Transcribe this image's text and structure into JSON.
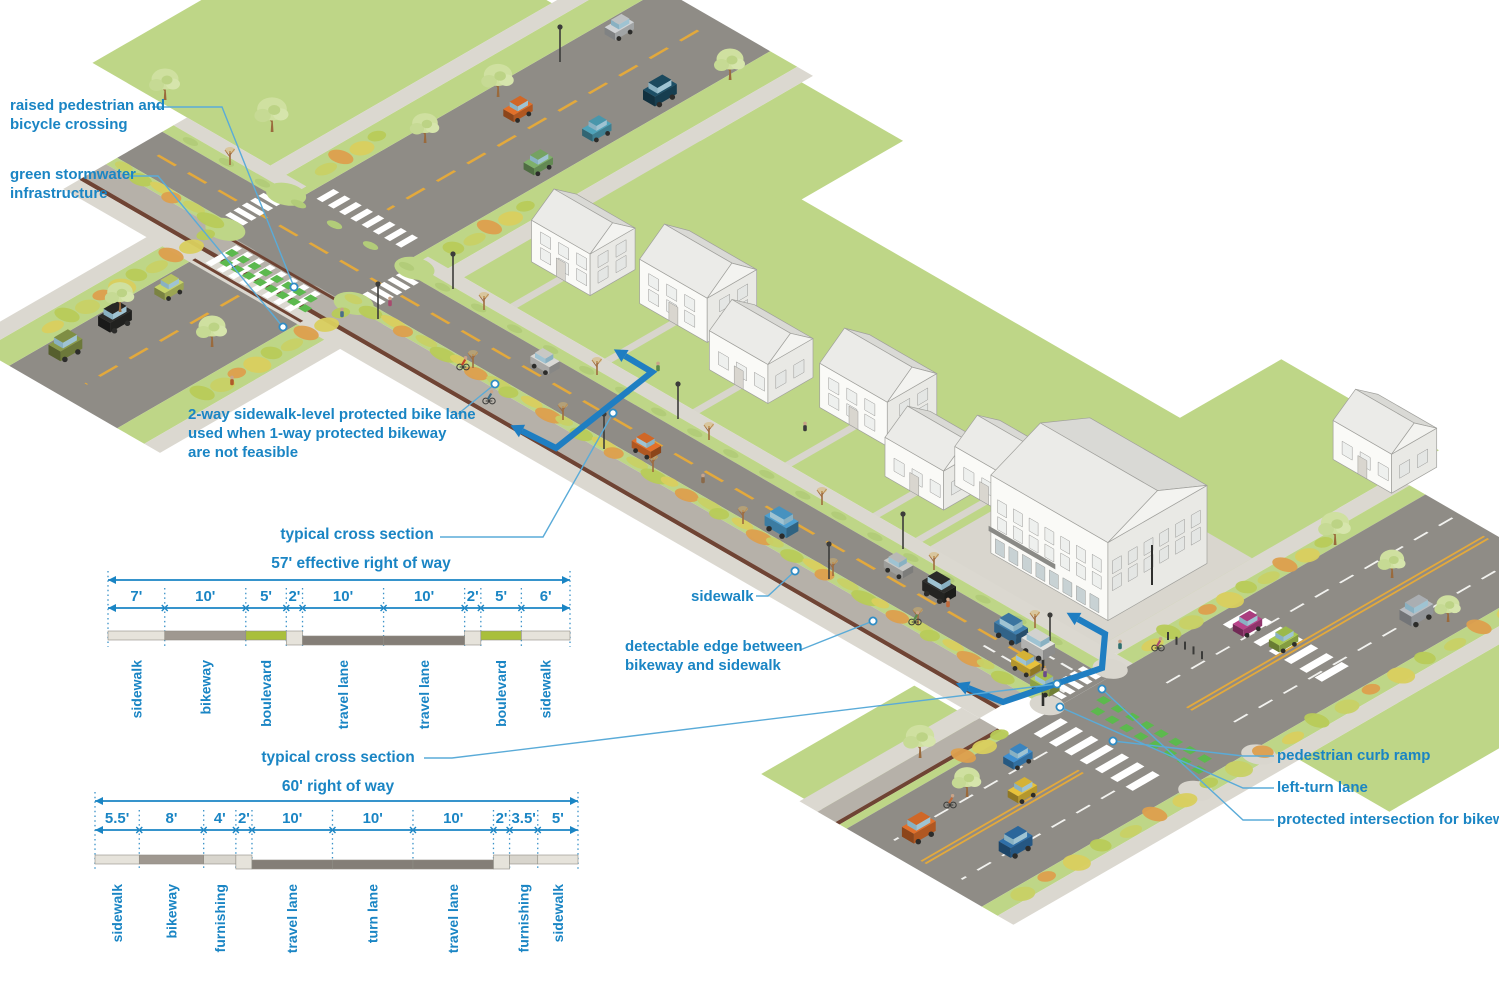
{
  "colors": {
    "accent": "#1a85c4",
    "leader": "#5aabd8",
    "section_marker_blue": "#1f7ec2",
    "road": "#8f8c86",
    "sidewalk": "#dbd8d0",
    "lawn": "#bed687",
    "boulevard_green": "#a9bf3b",
    "detectable_edge_brown": "#6f4434",
    "bike_crossing_green": "#5cb94e",
    "center_line_yellow": "#e3a93c",
    "bar_kinds": {
      "sidewalk": "#e6e3db",
      "bikeway": "#9f9890",
      "green": "#a9bf3b",
      "furnishing": "#d8d5cd",
      "curb": "#e6e3db",
      "road": "#847e77"
    }
  },
  "labels": [
    {
      "id": "raised-crossing",
      "lines": [
        "raised pedestrian and",
        "bicycle crossing"
      ]
    },
    {
      "id": "green-stormwater",
      "lines": [
        "green stormwater",
        "infrastructure"
      ]
    },
    {
      "id": "bike-lane-note",
      "lines": [
        "2-way sidewalk-level protected bike lane",
        "used when 1-way protected bikeway",
        "are not feasible"
      ]
    },
    {
      "id": "sidewalk",
      "lines": [
        "sidewalk"
      ]
    },
    {
      "id": "detectable-edge",
      "lines": [
        "detectable edge between",
        "bikeway and sidewalk"
      ]
    },
    {
      "id": "pedestrian-curb-ramp",
      "lines": [
        "pedestrian curb ramp"
      ]
    },
    {
      "id": "left-turn-lane",
      "lines": [
        "left-turn lane"
      ]
    },
    {
      "id": "protected-intersection",
      "lines": [
        "protected intersection for bikeway"
      ]
    }
  ],
  "sections": [
    {
      "name": "cross-section-57",
      "title": "typical cross section",
      "row_label": "57' effective right of way",
      "total": 57,
      "segments": [
        {
          "dim": "7'",
          "w": 7,
          "label": "sidewalk",
          "kind": "sidewalk"
        },
        {
          "dim": "10'",
          "w": 10,
          "label": "bikeway",
          "kind": "bikeway"
        },
        {
          "dim": "5'",
          "w": 5,
          "label": "boulevard",
          "kind": "green"
        },
        {
          "dim": "2'",
          "w": 2,
          "label": "",
          "kind": "curb"
        },
        {
          "dim": "10'",
          "w": 10,
          "label": "travel lane",
          "kind": "road"
        },
        {
          "dim": "10'",
          "w": 10,
          "label": "travel lane",
          "kind": "road"
        },
        {
          "dim": "2'",
          "w": 2,
          "label": "",
          "kind": "curb"
        },
        {
          "dim": "5'",
          "w": 5,
          "label": "boulevard",
          "kind": "green"
        },
        {
          "dim": "6'",
          "w": 6,
          "label": "sidewalk",
          "kind": "sidewalk"
        }
      ]
    },
    {
      "name": "cross-section-60",
      "title": "typical cross section",
      "row_label": "60' right of way",
      "total": 60,
      "segments": [
        {
          "dim": "5.5'",
          "w": 5.5,
          "label": "sidewalk",
          "kind": "sidewalk"
        },
        {
          "dim": "8'",
          "w": 8,
          "label": "bikeway",
          "kind": "bikeway"
        },
        {
          "dim": "4'",
          "w": 4,
          "label": "furnishing",
          "kind": "furnishing"
        },
        {
          "dim": "2'",
          "w": 2,
          "label": "",
          "kind": "curb"
        },
        {
          "dim": "10'",
          "w": 10,
          "label": "travel lane",
          "kind": "road"
        },
        {
          "dim": "10'",
          "w": 10,
          "label": "turn lane",
          "kind": "road"
        },
        {
          "dim": "10'",
          "w": 10,
          "label": "travel lane",
          "kind": "road"
        },
        {
          "dim": "2'",
          "w": 2,
          "label": "",
          "kind": "curb"
        },
        {
          "dim": "3.5'",
          "w": 3.5,
          "label": "furnishing",
          "kind": "furnishing"
        },
        {
          "dim": "5'",
          "w": 5,
          "label": "sidewalk",
          "kind": "sidewalk"
        }
      ]
    }
  ]
}
